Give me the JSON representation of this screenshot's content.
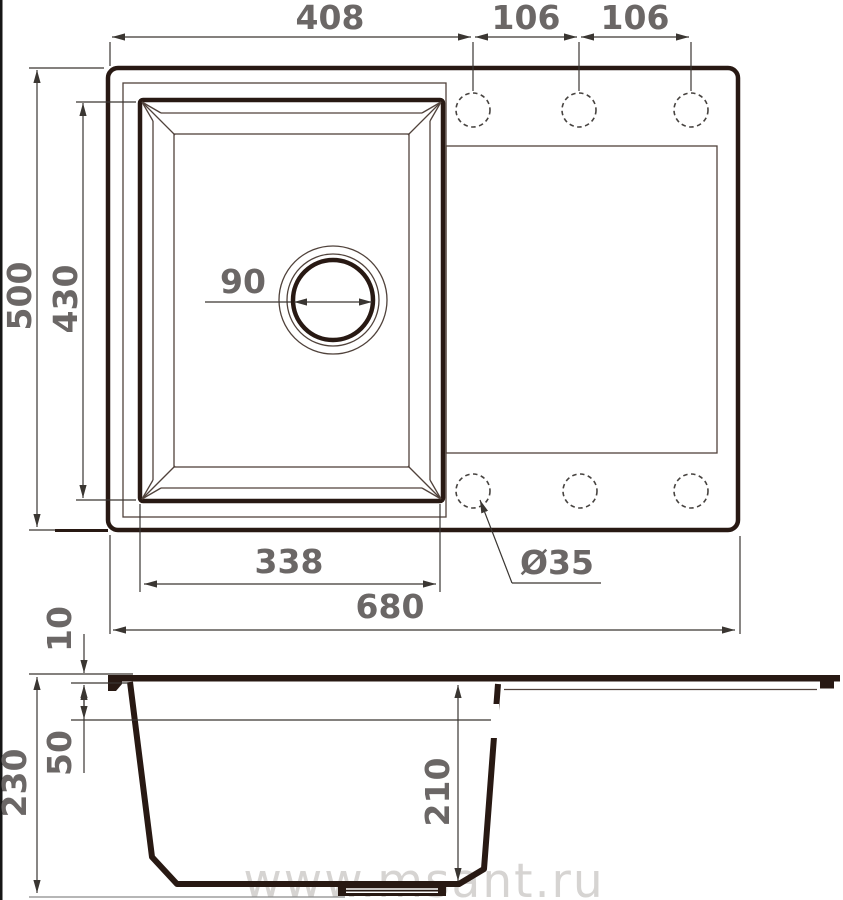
{
  "watermark": "www.msant.ru",
  "plan_view": {
    "description": "sink top view",
    "dims": {
      "left_edge_to_first_hole": "408",
      "hole_spacing_1": "106",
      "hole_spacing_2": "106",
      "overall_depth": "500",
      "bowl_outer_depth": "430",
      "drain_diameter": "90",
      "bowl_outer_width": "338",
      "faucet_hole_diameter": "Ø35",
      "overall_width": "680"
    }
  },
  "side_view": {
    "description": "sink section view",
    "dims": {
      "rim_height": "10",
      "overflow_offset": "50",
      "total_height": "230",
      "bowl_inner_depth": "210"
    }
  },
  "colors": {
    "outline": "#281913",
    "thin_line": "#50423b",
    "dimension_line": "#3a3632",
    "dimension_text": "#6b6766",
    "watermark": "#d0cdcb",
    "background": "#ffffff"
  }
}
